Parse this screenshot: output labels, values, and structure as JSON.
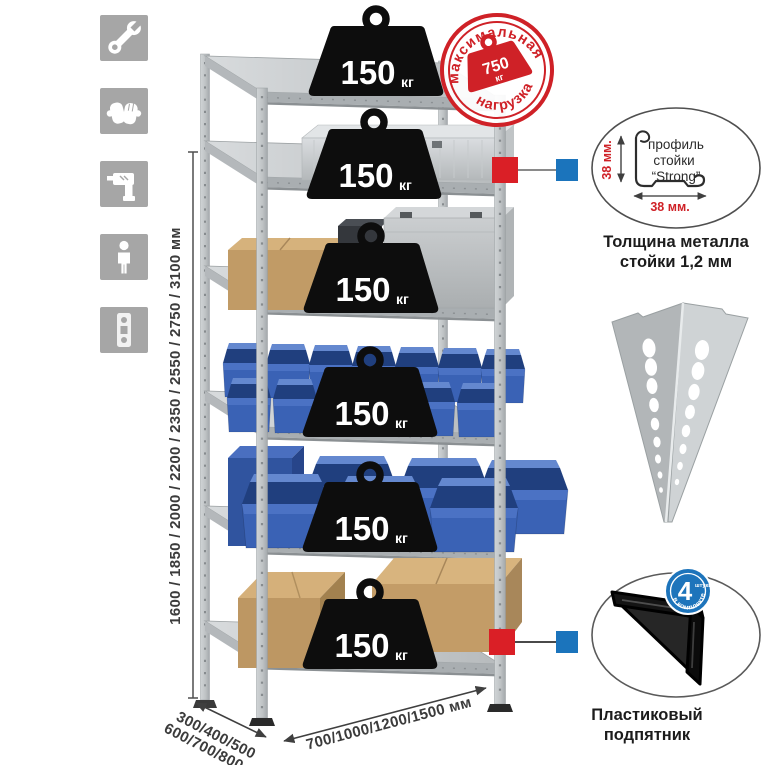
{
  "colors": {
    "accent_red": "#cf2127",
    "accent_blue": "#1b74bc",
    "bin_blue": "#3a62b5",
    "metal_gray": "#c3c7c9",
    "cardboard": "#c19b66"
  },
  "sidebar": {
    "icons": [
      {
        "name": "wrench-icon"
      },
      {
        "name": "gloves-icon"
      },
      {
        "name": "drill-icon"
      },
      {
        "name": "person-icon"
      },
      {
        "name": "post-strip-icon"
      }
    ]
  },
  "dims": {
    "height": "1600 / 1850 / 2000 / 2200 / 2350 / 2550 / 2750 / 3100 мм",
    "depth_line1": "300/400/500",
    "depth_line2": "600/700/800 мм",
    "width": "700/1000/1200/1500 мм"
  },
  "stamp": {
    "arc_top": "максимальная",
    "arc_bottom": "нагрузка",
    "value": "750",
    "unit": "кг"
  },
  "shelf_load": {
    "value": "150",
    "unit": "кг"
  },
  "profile_detail": {
    "label_line1": "профиль",
    "label_line2": "стойки",
    "label_line3": "“Strong”",
    "dim_v": "38 мм.",
    "dim_h": "38 мм.",
    "caption_line1": "Толщина металла",
    "caption_line2": "стойки 1,2 мм"
  },
  "foot_detail": {
    "badge_count": "4",
    "badge_small": "штуки",
    "badge_arc": "в комплекте",
    "caption_line1": "Пластиковый",
    "caption_line2": "подпятник"
  }
}
